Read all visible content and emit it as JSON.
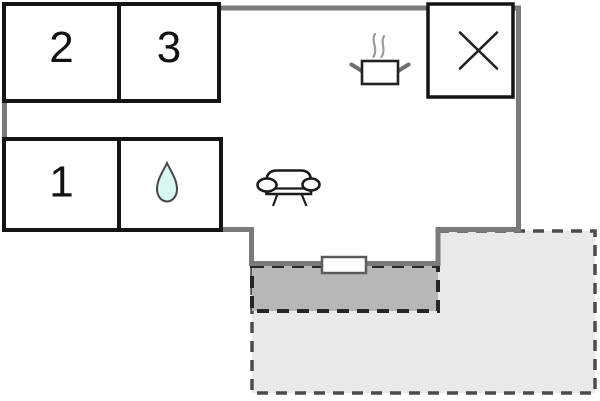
{
  "colors": {
    "wall": "#7a7a7a",
    "room_border": "#141414",
    "terrace_light": "#e9e9e9",
    "terrace_dark": "#b7b7b7",
    "drop_fill": "#d9f7f2",
    "background": "#ffffff"
  },
  "rooms": {
    "room2": {
      "label": "2"
    },
    "room3": {
      "label": "3"
    },
    "room1": {
      "label": "1"
    },
    "bathroom": {
      "icon": "water-drop-icon"
    }
  },
  "icons": {
    "kitchen": "steaming-pot-icon",
    "living": "sofa-icon",
    "utility": "x-mark-icon",
    "opening": "window-door-marker"
  }
}
